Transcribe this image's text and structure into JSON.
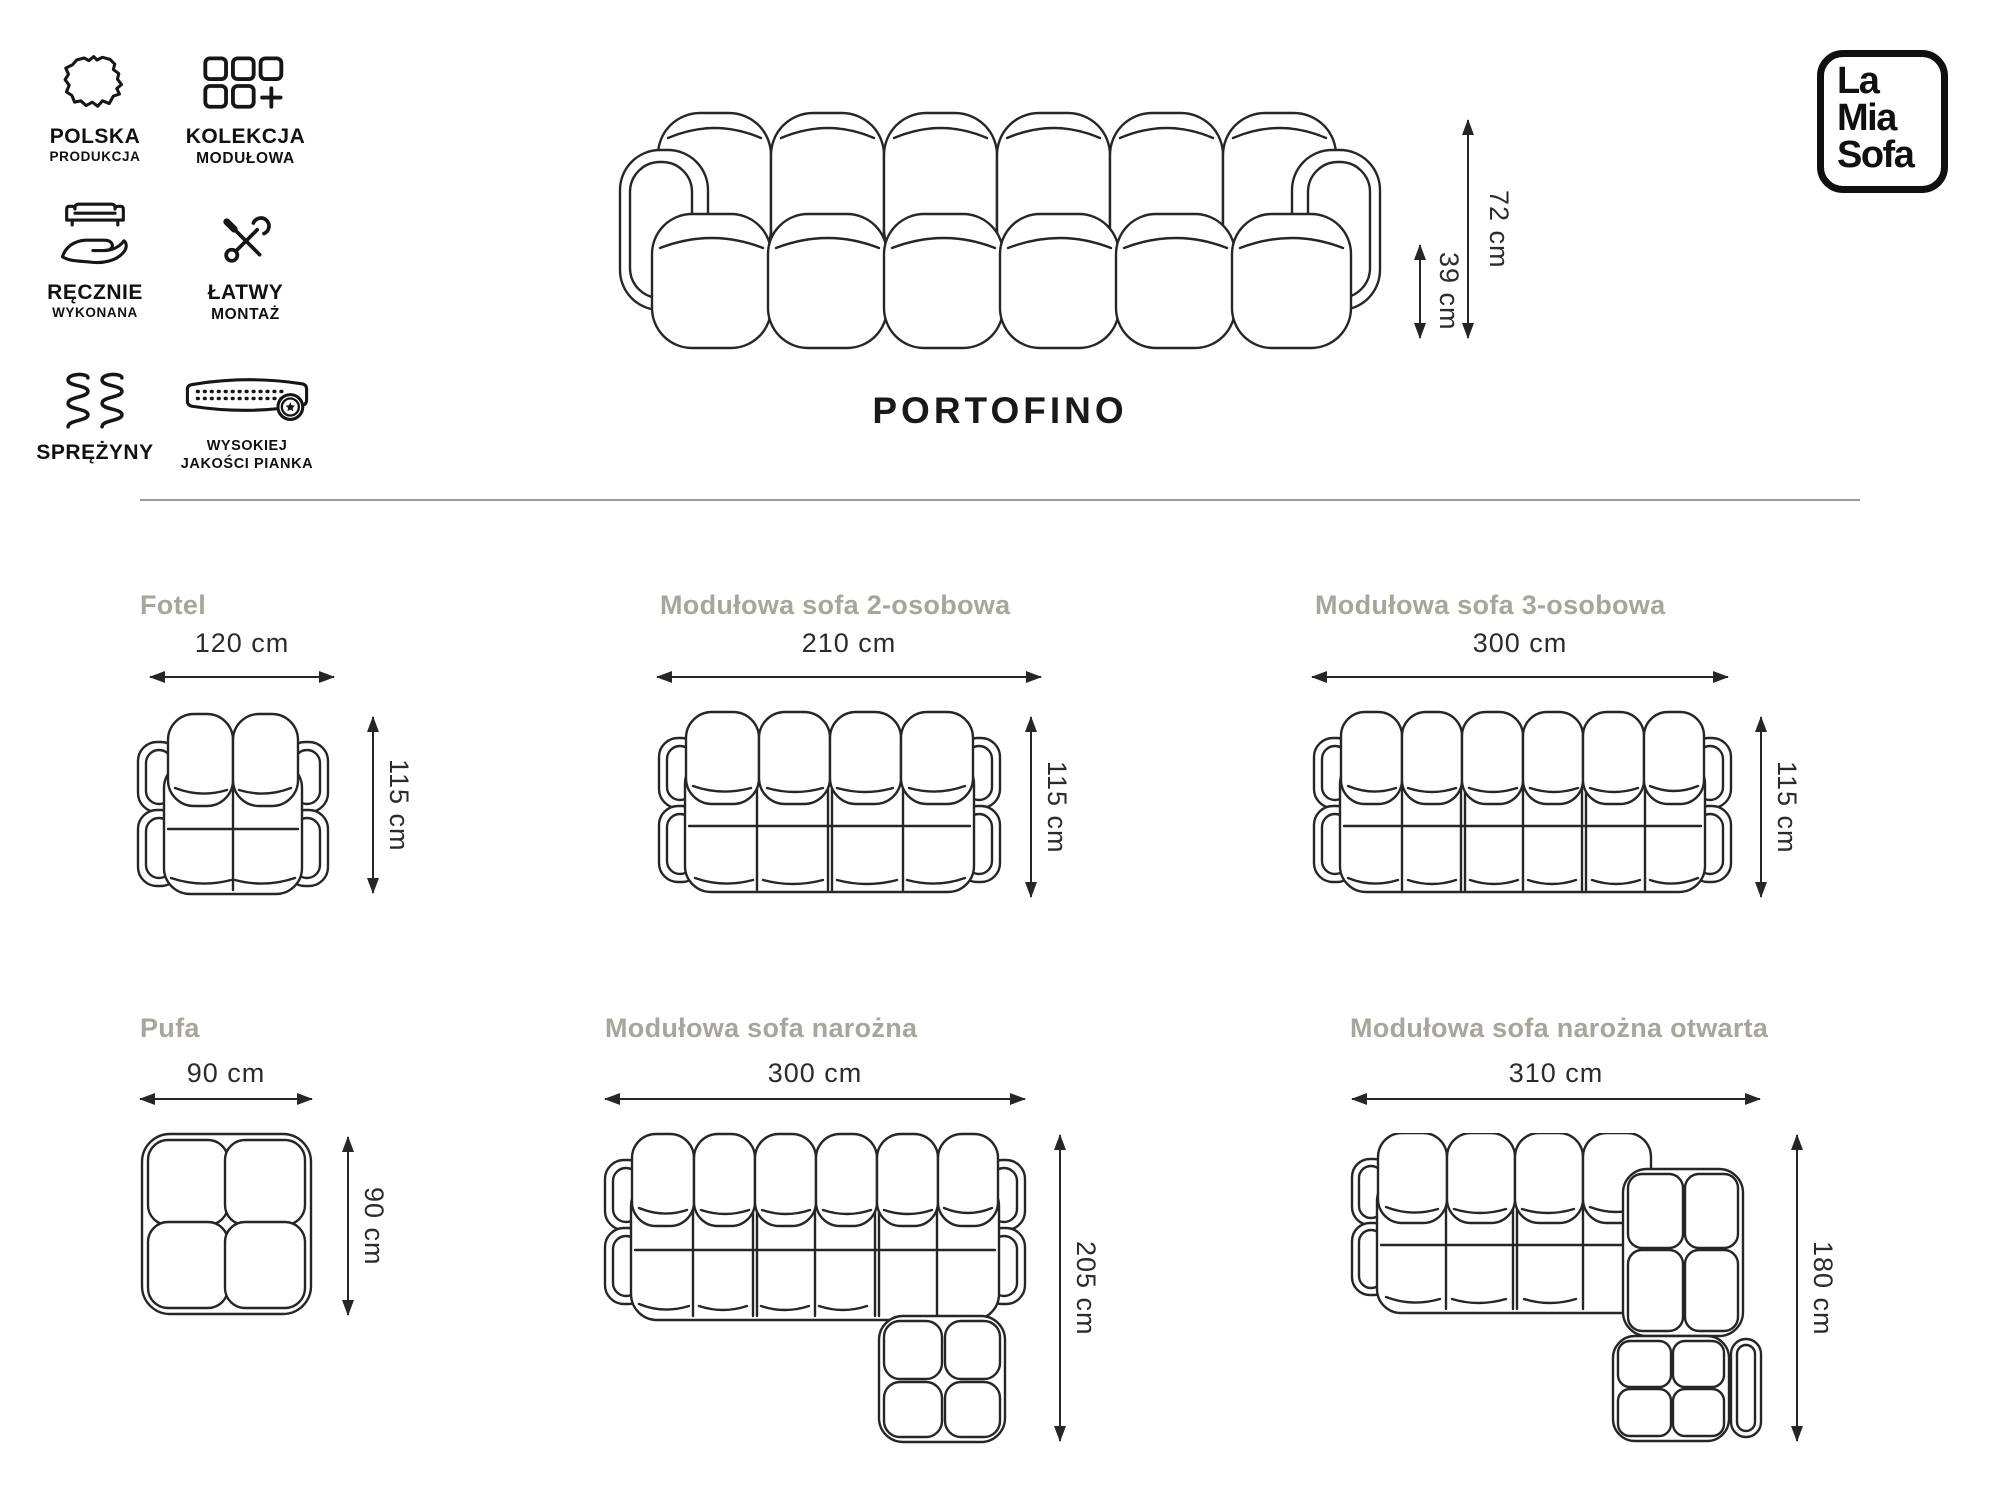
{
  "header": {
    "badges": [
      {
        "icon": "poland-map-icon",
        "line1": "POLSKA",
        "line2": "PRODUKCJA"
      },
      {
        "icon": "modular-collection-icon",
        "line1": "KOLEKCJA",
        "line2": "MODUŁOWA"
      },
      {
        "icon": "handmade-icon",
        "line1": "RĘCZNIE",
        "line2": "WYKONANA"
      },
      {
        "icon": "easy-assembly-icon",
        "line1": "ŁATWY",
        "line2": "MONTAŻ"
      },
      {
        "icon": "springs-icon",
        "line1": "SPRĘŻYNY",
        "line2": ""
      },
      {
        "icon": "foam-quality-icon",
        "line1": "WYSOKIEJ",
        "line2": "JAKOŚCI PIANKA"
      }
    ],
    "logo": {
      "line1": "La",
      "line2": "Mia",
      "line3": "Sofa"
    },
    "product_name": "PORTOFINO",
    "front_view": {
      "total_height": "72 cm",
      "seat_height": "39 cm"
    }
  },
  "variants": [
    {
      "name": "Fotel",
      "width": "120 cm",
      "depth": "115 cm"
    },
    {
      "name": "Modułowa sofa 2-osobowa",
      "width": "210 cm",
      "depth": "115 cm"
    },
    {
      "name": "Modułowa sofa 3-osobowa",
      "width": "300 cm",
      "depth": "115 cm"
    },
    {
      "name": "Pufa",
      "width": "90 cm",
      "depth": "90 cm"
    },
    {
      "name": "Modułowa sofa narożna",
      "width": "300 cm",
      "depth": "205 cm"
    },
    {
      "name": "Modułowa sofa narożna otwarta",
      "width": "310 cm",
      "depth": "180 cm"
    }
  ],
  "colors": {
    "line": "#262626",
    "variant_title": "#a7a59c",
    "divider": "#9d9d9d",
    "background": "#ffffff"
  }
}
